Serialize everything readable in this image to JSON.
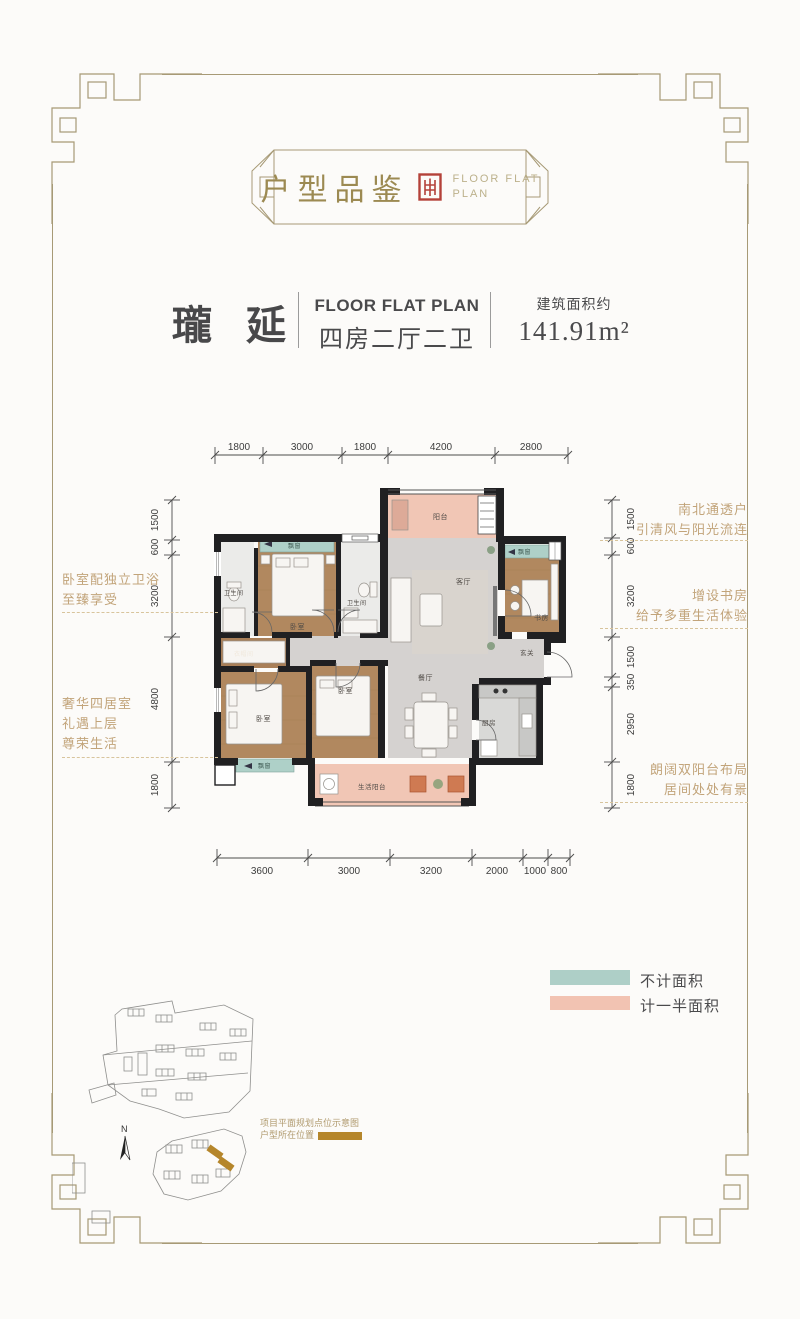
{
  "badge": {
    "title": "户型品鉴",
    "subtitle_line1": "FLOOR FLAT",
    "subtitle_line2": "PLAN"
  },
  "title_block": {
    "name": "瓏 延",
    "plan_en": "FLOOR FLAT PLAN",
    "layout": "四房二厅二卫",
    "area_label": "建筑面积约",
    "area_value": "141.91",
    "area_unit": "m²"
  },
  "dimensions": {
    "top": [
      "1800",
      "3000",
      "1800",
      "4200",
      "2800"
    ],
    "bottom": [
      "3600",
      "3000",
      "3200",
      "2000",
      "1000",
      "800"
    ],
    "left": [
      "1500",
      "600",
      "3200",
      "4800",
      "1800"
    ],
    "right": [
      "1500",
      "600",
      "3200",
      "1500",
      "350",
      "2950",
      "1800"
    ]
  },
  "annotations": {
    "left1_line1": "卧室配独立卫浴",
    "left1_line2": "至臻享受",
    "left2_line1": "奢华四居室",
    "left2_line2": "礼遇上层",
    "left2_line3": "尊荣生活",
    "right1_line1": "南北通透户",
    "right1_line2": "引清风与阳光流连",
    "right2_line1": "增设书房",
    "right2_line2": "给予多重生活体验",
    "right3_line1": "朗阔双阳台布局",
    "right3_line2": "居间处处有景"
  },
  "rooms": {
    "balcony": "阳台",
    "bathroom": "卫生间",
    "bay_window": "飘窗",
    "bedroom": "卧室",
    "living": "客厅",
    "study": "书房",
    "entry": "玄关",
    "cloakroom": "衣帽间",
    "dining": "餐厅",
    "kitchen": "厨房",
    "life_balcony": "生活阳台"
  },
  "legend": {
    "item1_label": "不计面积",
    "item1_color": "#aecfc7",
    "item2_label": "计一半面积",
    "item2_color": "#f2c3b2"
  },
  "site_plan": {
    "north_label": "N",
    "note_line1": "项目平面规划点位示意图",
    "note_line2": "户型所在位置",
    "highlight_color": "#b5862b"
  },
  "colors": {
    "frame_gold": "#a79a76",
    "seal_red": "#b4423a",
    "annotation_tan": "#c2a47a",
    "wall": "#202022",
    "bay_teal": "#aed0c8",
    "balcony_pink": "#f1c6b5"
  }
}
